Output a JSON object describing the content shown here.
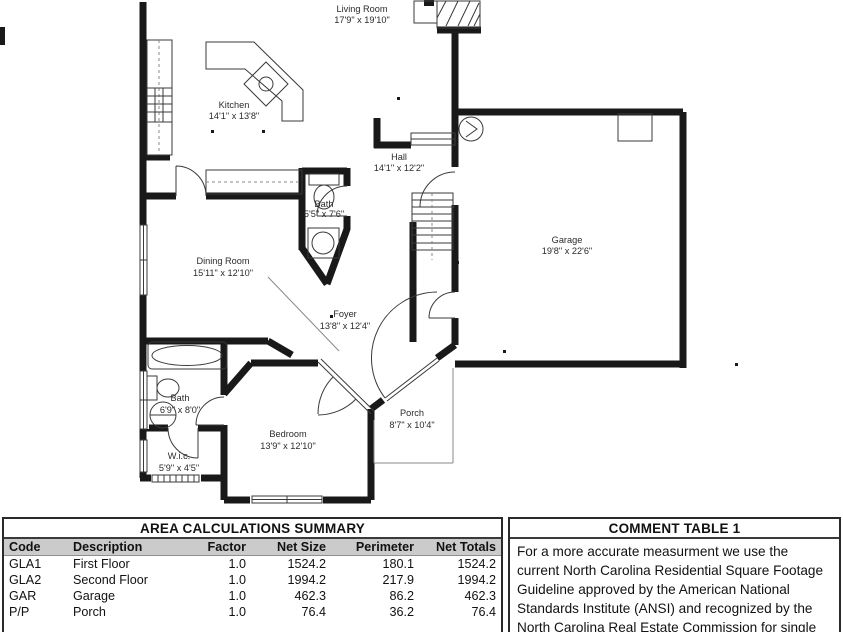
{
  "floor_plan": {
    "rooms": [
      {
        "name": "Living Room",
        "dims": "17'9\" x 19'10\""
      },
      {
        "name": "Kitchen",
        "dims": "14'1\" x 13'8\""
      },
      {
        "name": "Hall",
        "dims": "14'1\" x 12'2\""
      },
      {
        "name": "Bath",
        "dims": "5'5\" x 7'6\""
      },
      {
        "name": "Dining Room",
        "dims": "15'11\" x 12'10\""
      },
      {
        "name": "Garage",
        "dims": "19'8\" x 22'6\""
      },
      {
        "name": "Foyer",
        "dims": "13'8\" x 12'4\""
      },
      {
        "name": "Bath",
        "dims": "6'9\" x 8'0\""
      },
      {
        "name": "W.i.c.",
        "dims": "5'9\" x 4'5\""
      },
      {
        "name": "Bedroom",
        "dims": "13'9\" x 12'10\""
      },
      {
        "name": "Porch",
        "dims": "8'7\" x 10'4\""
      }
    ]
  },
  "area_table": {
    "title": "AREA CALCULATIONS SUMMARY",
    "columns": [
      "Code",
      "Description",
      "Factor",
      "Net Size",
      "Perimeter",
      "Net Totals"
    ],
    "rows": [
      [
        "GLA1",
        "First Floor",
        "1.0",
        "1524.2",
        "180.1",
        "1524.2"
      ],
      [
        "GLA2",
        "Second Floor",
        "1.0",
        "1994.2",
        "217.9",
        "1994.2"
      ],
      [
        "GAR",
        "Garage",
        "1.0",
        "462.3",
        "86.2",
        "462.3"
      ],
      [
        "P/P",
        "Porch",
        "1.0",
        "76.4",
        "36.2",
        "76.4"
      ]
    ]
  },
  "comment_table": {
    "title": "COMMENT TABLE 1",
    "text": "For a more accurate measurment we use the\ncurrent North Carolina Residential Square Footage\nGuideline approved by the American National\nStandards Institute (ANSI) and recognized by the\nNorth Carolina Real Estate Commission for single\nfamily dwellings and town-homes for both North"
  }
}
